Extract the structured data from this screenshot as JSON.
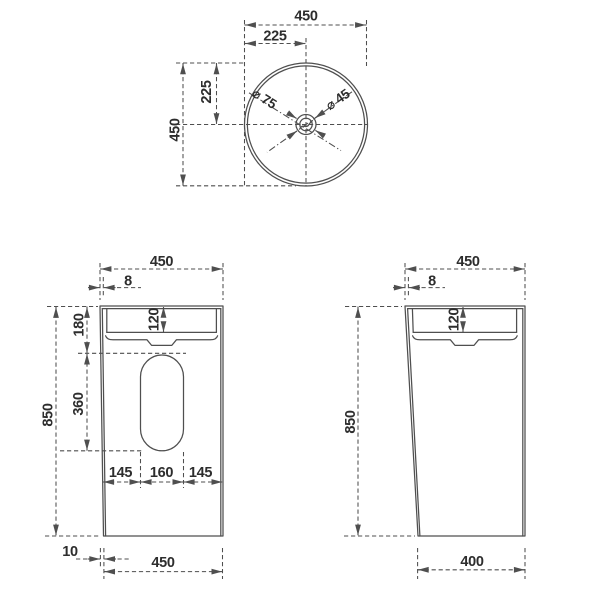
{
  "colors": {
    "line": "#4f4f4f",
    "text": "#2d2d2d",
    "background": "#ffffff"
  },
  "views": {
    "top": {
      "dims": {
        "width": "450",
        "half_width": "225",
        "height": "450",
        "half_height": "225",
        "drain": "⌀ 75",
        "faucet": "⌀ 45"
      }
    },
    "front": {
      "dims": {
        "top_width": "450",
        "rim_offset": "8",
        "basin_depth": "120",
        "upper_height": "180",
        "cutout_height": "360",
        "total_height": "850",
        "cutout_left": "145",
        "cutout_width": "160",
        "cutout_right": "145",
        "base_inset": "10",
        "bottom_width": "450"
      }
    },
    "side": {
      "dims": {
        "top_width": "450",
        "rim_offset": "8",
        "basin_depth": "120",
        "total_height": "850",
        "bottom_width": "400"
      }
    }
  }
}
